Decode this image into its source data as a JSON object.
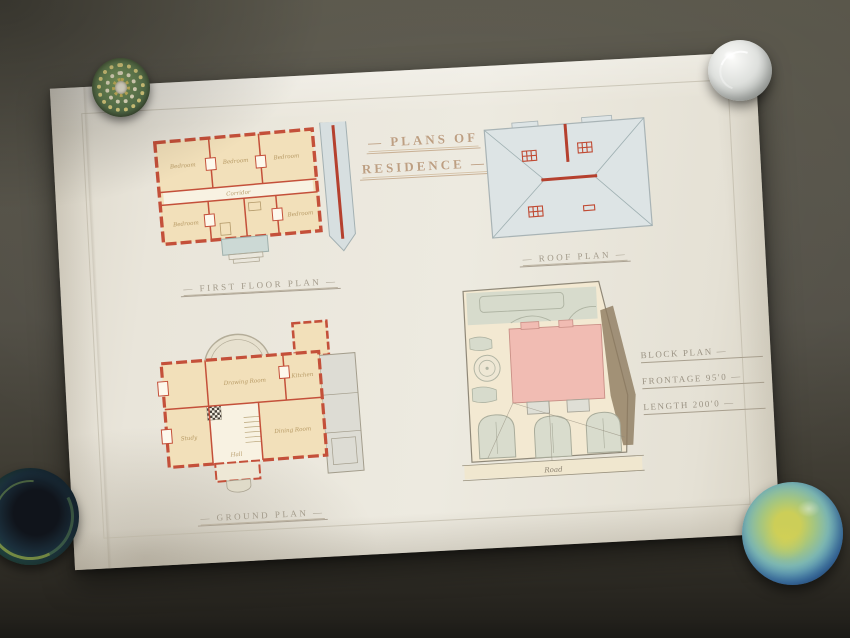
{
  "scene": {
    "background_color": "#514e45",
    "paper_color": "#e9e5da"
  },
  "sheet": {
    "title": {
      "line1": "— PLANS OF",
      "line2": "RESIDENCE —"
    },
    "captions": {
      "first_floor": "— FIRST FLOOR PLAN —",
      "roof": "— ROOF PLAN —",
      "ground": "— GROUND PLAN —",
      "block_line1": "BLOCK PLAN —",
      "block_line2": "FRONTAGE 95'0 —",
      "block_line3": "LENGTH 200'0 —"
    },
    "annotations": {
      "road": "Road"
    },
    "rooms": {
      "first_floor": [
        "Bedroom",
        "Bedroom",
        "Bedroom",
        "Corridor",
        "Bedroom",
        "Bedroom"
      ],
      "ground": [
        "Drawing Room",
        "Hall",
        "Dining Room",
        "Kitchen",
        "Study"
      ]
    },
    "palette": {
      "wall_red": "#c4503a",
      "room_cream": "#f2e0ba",
      "roof_grey": "#dde4e5",
      "ridge_red": "#b5402e",
      "site_pink": "#f1bcb3",
      "garden_green": "#d7dbcc",
      "ink_brown": "#bd9f82",
      "pencil_grey": "#a29a8a"
    }
  },
  "paperweights": [
    {
      "id": "top-left",
      "type": "millefiori-glass",
      "colors": [
        "#86a463",
        "#e3d584",
        "#f1ecdb"
      ]
    },
    {
      "id": "top-right",
      "type": "clear-glass",
      "colors": [
        "#fbfbf9",
        "#b2b6b2"
      ]
    },
    {
      "id": "bottom-left",
      "type": "dark-teal-glass",
      "colors": [
        "#10141b",
        "#33624a",
        "#bacd4a"
      ]
    },
    {
      "id": "bottom-right",
      "type": "blue-mottled-glass",
      "colors": [
        "#ccce58",
        "#4a8bc0",
        "#1d4679"
      ]
    }
  ]
}
